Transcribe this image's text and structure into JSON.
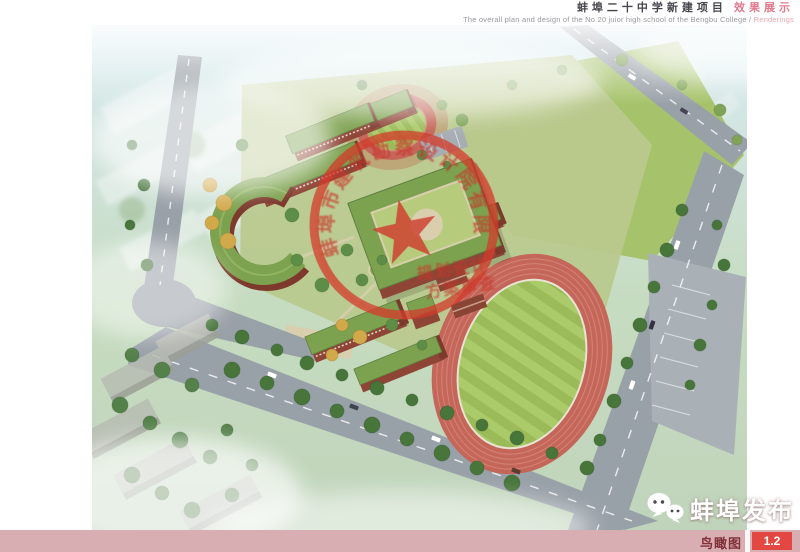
{
  "header": {
    "title": "蚌埠二十中学新建项目",
    "title_accent": "效果展示",
    "subtitle": "The overall plan and design of the No 20 juior high  school  of the Bengbu College /",
    "subtitle_accent": "Renderings"
  },
  "rendering": {
    "type": "aerial-birds-eye-architectural-rendering",
    "stamp": {
      "arc_text": "蚌埠市建筑勘察设计院有限公司",
      "line1": "规划设计",
      "line2": "方案审查",
      "color": "#cf392b"
    },
    "colors": {
      "track": "#c4675a",
      "field_green": "#a9c767",
      "roof_green": "#7da24f",
      "brick_red": "#8f4536",
      "road_gray": "#99a1a8",
      "haze_blue": "#d8ecf1"
    }
  },
  "footer": {
    "caption": "鸟瞰图",
    "page_number": "1.2",
    "colors": {
      "bar": "#d9aeb2",
      "caption_text": "#7f3038",
      "page_box": "#e24841"
    }
  },
  "watermark": {
    "text": "蚌埠发布",
    "icon": "wechat-chat-bubbles-icon"
  }
}
